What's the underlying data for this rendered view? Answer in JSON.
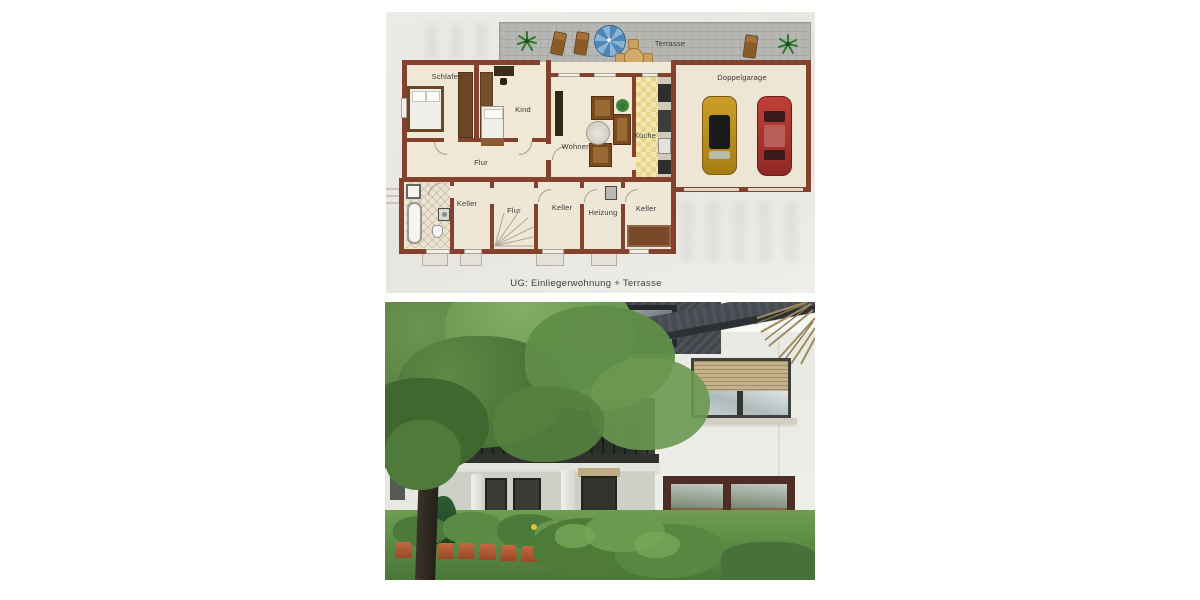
{
  "page": {
    "background": "#ffffff"
  },
  "floor_plan": {
    "caption": "UG: Einliegerwohnung + Terrasse",
    "labels": {
      "terrasse": "Terrasse",
      "schlafen": "Schlafen",
      "kind": "Kind",
      "flur_og": "Flur",
      "wohnen": "Wohnen",
      "kueche": "Küche",
      "doppelgarage": "Doppelgarage",
      "keller_a": "Keller",
      "flur_ug": "Flur",
      "keller_b": "Keller",
      "heizung": "Heizung",
      "keller_c": "Keller"
    },
    "colors": {
      "paper": "#e9e7e1",
      "wall": "#82422e",
      "room_floor": "#f0e8d4",
      "terrace_tile": "#b6b6b2",
      "kitchen_tile": "#ecdf9c",
      "umbrella_blue": "#4e86b6",
      "car_gold": "#c09a22",
      "car_red": "#b23a30"
    }
  },
  "photo": {
    "alt": "White two-storey house with slate roof, balcony, flower pots and large garden tree",
    "colors": {
      "wall": "#e9ebe4",
      "roof": "#45494f",
      "shutter": "#c6b28a",
      "lawn": "#5d8c45",
      "foliage": "#567f42",
      "pots": "#a8522f"
    }
  }
}
